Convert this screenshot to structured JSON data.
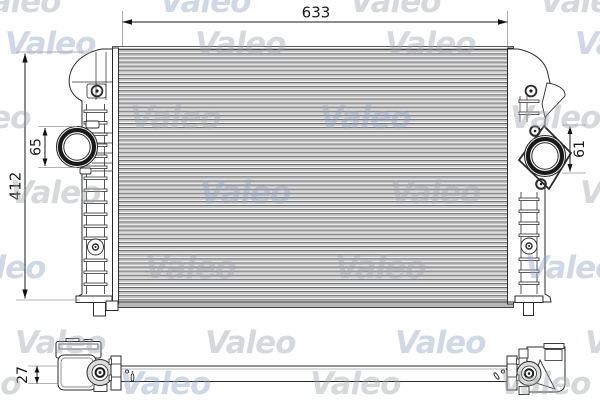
{
  "watermark": {
    "text": "Valeo",
    "gray": "#a0a5ac",
    "blue": "#8fa3c6"
  },
  "front_view": {
    "width_dim": "633",
    "height_dim": "412",
    "left_port_dim": "65",
    "right_port_dim": "61"
  },
  "bottom_view": {
    "depth_dim": "27"
  },
  "colors": {
    "outline": "#2b2b2b",
    "ext_line": "#9a9a9a",
    "fin_dark": "#5f5f5f",
    "fin_gray": "#c3c3c3"
  }
}
